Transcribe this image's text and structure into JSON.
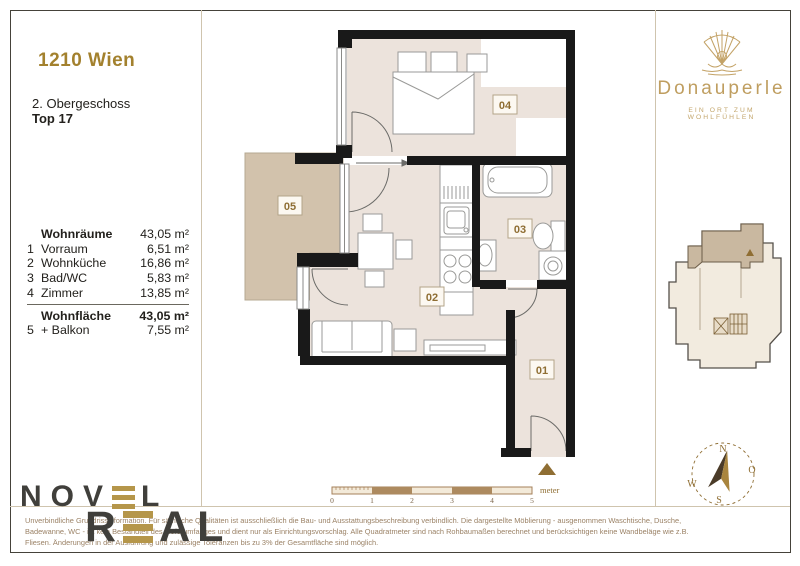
{
  "header": {
    "location": "1210 Wien",
    "floor": "2. Obergeschoss",
    "unit": "Top 17"
  },
  "area_table": {
    "group_label": "Wohnräume",
    "group_value": "43,05 m²",
    "rows": [
      {
        "num": "1",
        "label": "Vorraum",
        "value": "6,51 m²"
      },
      {
        "num": "2",
        "label": "Wohnküche",
        "value": "16,86 m²"
      },
      {
        "num": "3",
        "label": "Bad/WC",
        "value": "5,83 m²"
      },
      {
        "num": "4",
        "label": "Zimmer",
        "value": "13,85 m²"
      }
    ],
    "total_label": "Wohnfläche",
    "total_value": "43,05 m²",
    "balcony_num": "5",
    "balcony_label": "+ Balkon",
    "balcony_value": "7,55 m²"
  },
  "brand": {
    "name": "Donauperle",
    "tagline": "EIN ORT ZUM WOHLFÜHLEN"
  },
  "logo": {
    "word1_start": "NOV",
    "word1_end": "L",
    "word2_start": "R",
    "word2_end": "AL"
  },
  "plan": {
    "labels": {
      "hall": "01",
      "kitchen": "02",
      "bath": "03",
      "room": "04",
      "balcony": "05"
    }
  },
  "scale_bar": {
    "ticks": [
      "0",
      "1",
      "2",
      "3",
      "4",
      "5"
    ],
    "unit": "meter"
  },
  "compass": {
    "n": "N",
    "e": "O",
    "s": "S",
    "w": "W"
  },
  "disclaimer": {
    "line1": "Unverbindliche Grundrissinformation. Für sämtliche Qualitäten ist ausschließlich die Bau- und Ausstattungsbeschreibung verbindlich. Die dargestellte Möblierung - ausgenommen Waschtische, Dusche,",
    "line2": "Badewanne, WC - ist kein Bestandteil des Lieferumfanges und dient nur als Einrichtungsvorschlag. Alle Quadratmeter sind nach Rohbaumaßen berechnet und berücksichtigen keine Wandbeläge wie z.B.",
    "line3": "Fliesen. Änderungen in der Ausführung und zulässige Toleranzen bis zu 3% der Gesamtfläche sind möglich."
  },
  "colors": {
    "accent_gold": "#a3812e",
    "brand_gold": "#bf9e60",
    "wall_black": "#191919",
    "floor_beige": "#ece3dc",
    "balcony_tan": "#d2c2ac",
    "scale_brown": "#ad8a5f"
  }
}
